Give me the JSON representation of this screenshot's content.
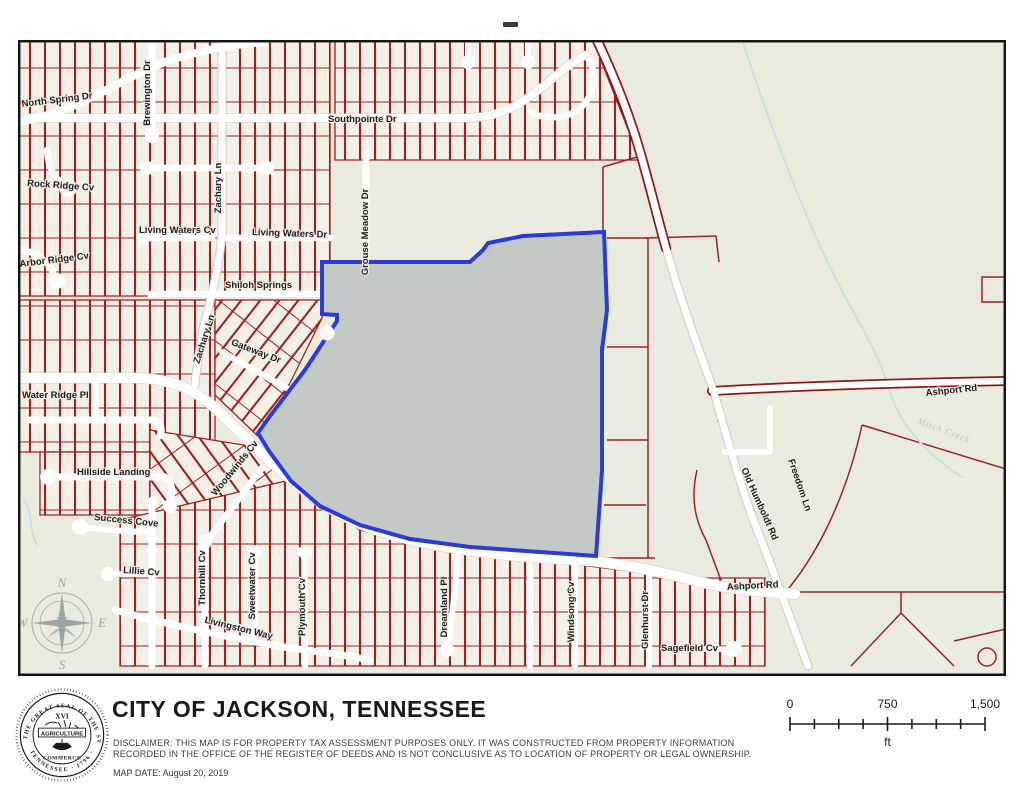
{
  "window": {
    "top_marker": "-"
  },
  "map": {
    "colors": {
      "parcel_line": "#a0201f",
      "highlight_fill": "#c3cac6",
      "highlight_stroke": "#2a3bd8",
      "road": "#ffffff",
      "open_land": "#e9ebdf",
      "subdivision_land": "#f3f1e7",
      "water": "#c9dfe5"
    },
    "compass": {
      "north": "N",
      "east": "E",
      "south": "S",
      "west": "W"
    },
    "street_labels": [
      {
        "id": "north-spring-dr",
        "t": "North Spring Dr",
        "x": 22,
        "y": 107,
        "r": -7,
        "a": "s"
      },
      {
        "id": "brewington-dr",
        "t": "Brewington Dr",
        "x": 150,
        "y": 93,
        "r": -90,
        "a": "m"
      },
      {
        "id": "southpointe-dr",
        "t": "Southpointe Dr",
        "x": 328,
        "y": 122,
        "r": 0,
        "a": "s"
      },
      {
        "id": "rock-ridge-cv",
        "t": "Rock Ridge Cv",
        "x": 27,
        "y": 186,
        "r": 4,
        "a": "s"
      },
      {
        "id": "zachary-ln-upper",
        "t": "Zachary Ln",
        "x": 221,
        "y": 188,
        "r": -90,
        "a": "m"
      },
      {
        "id": "living-waters-cv",
        "t": "Living Waters Cv",
        "x": 139,
        "y": 233,
        "r": 0,
        "a": "s"
      },
      {
        "id": "living-waters-dr",
        "t": "Living Waters Dr",
        "x": 252,
        "y": 235,
        "r": 2,
        "a": "s"
      },
      {
        "id": "grouse-meadow-dr",
        "t": "Grouse Meadow Dr",
        "x": 368,
        "y": 232,
        "r": -90,
        "a": "m"
      },
      {
        "id": "arbor-ridge-cv",
        "t": "Arbor Ridge Cv",
        "x": 20,
        "y": 267,
        "r": -7,
        "a": "s"
      },
      {
        "id": "shiloh-springs",
        "t": "Shiloh Springs",
        "x": 225,
        "y": 288,
        "r": 0,
        "a": "s"
      },
      {
        "id": "zachary-ln-lower",
        "t": "Zachary Ln",
        "x": 207,
        "y": 340,
        "r": -72,
        "a": "m"
      },
      {
        "id": "gateway-dr",
        "t": "Gateway Dr",
        "x": 255,
        "y": 354,
        "r": 21,
        "a": "m"
      },
      {
        "id": "water-ridge-pl",
        "t": "Water Ridge Pl",
        "x": 22,
        "y": 398,
        "r": 0,
        "a": "s"
      },
      {
        "id": "hillside-landing",
        "t": "Hillside Landing",
        "x": 77,
        "y": 475,
        "r": 0,
        "a": "s"
      },
      {
        "id": "woodwinds-cv",
        "t": "Woodwinds Cv",
        "x": 237,
        "y": 470,
        "r": -51,
        "a": "m"
      },
      {
        "id": "success-cove",
        "t": "Success Cove",
        "x": 94,
        "y": 520,
        "r": 6,
        "a": "s"
      },
      {
        "id": "lillie-cv",
        "t": "Lillie Cv",
        "x": 123,
        "y": 573,
        "r": 4,
        "a": "s"
      },
      {
        "id": "thornhill-cv",
        "t": "Thornhill Cv",
        "x": 205,
        "y": 578,
        "r": -90,
        "a": "m"
      },
      {
        "id": "sweetwater-cv",
        "t": "Sweetwater Cv",
        "x": 255,
        "y": 586,
        "r": -90,
        "a": "m"
      },
      {
        "id": "plymouth-cv",
        "t": "Plymouth Cv",
        "x": 305,
        "y": 607,
        "r": -90,
        "a": "m"
      },
      {
        "id": "livingston-way",
        "t": "Livingston Way",
        "x": 238,
        "y": 631,
        "r": 14,
        "a": "m"
      },
      {
        "id": "dreamland-pl",
        "t": "Dreamland Pl",
        "x": 447,
        "y": 607,
        "r": -90,
        "a": "m"
      },
      {
        "id": "windsong-cv",
        "t": "Windsong Cv",
        "x": 574,
        "y": 612,
        "r": -90,
        "a": "m"
      },
      {
        "id": "glenhurst-dr",
        "t": "Glenhurst Dr",
        "x": 648,
        "y": 620,
        "r": -90,
        "a": "m"
      },
      {
        "id": "sagefield-cv",
        "t": "Sagefield Cv",
        "x": 661,
        "y": 651,
        "r": 0,
        "a": "s"
      },
      {
        "id": "ashport-rd-south",
        "t": "Ashport Rd",
        "x": 727,
        "y": 590,
        "r": -3,
        "a": "s"
      },
      {
        "id": "ashport-rd-north",
        "t": "Ashport Rd",
        "x": 926,
        "y": 396,
        "r": -6,
        "a": "s"
      },
      {
        "id": "old-humboldt-rd",
        "t": "Old Humboldt Rd",
        "x": 757,
        "y": 505,
        "r": 66,
        "a": "m"
      },
      {
        "id": "freedom-ln",
        "t": "Freedom Ln",
        "x": 797,
        "y": 486,
        "r": 71,
        "a": "m"
      },
      {
        "id": "mitch-creek",
        "t": "Mitch Creek",
        "x": 943,
        "y": 433,
        "r": 21,
        "a": "m",
        "s": "water"
      }
    ]
  },
  "footer": {
    "title": "CITY OF JACKSON, TENNESSEE",
    "disclaimer_line1": "DISCLAIMER: THIS MAP IS FOR PROPERTY TAX ASSESSMENT PURPOSES ONLY. IT WAS CONSTRUCTED FROM PROPERTY INFORMATION",
    "disclaimer_line2": "RECORDED IN THE OFFICE OF THE REGISTER OF DEEDS AND IS NOT CONCLUSIVE AS TO LOCATION OF PROPERTY OR LEGAL OWNERSHIP.",
    "map_date": "MAP DATE: August 20, 2019",
    "seal": {
      "ring_top": "THE GREAT SEAL OF THE STATE OF",
      "ring_bottom": "TENNESSEE · 1796 ·",
      "roman_numeral": "XVI",
      "agriculture": "AGRICULTURE",
      "commerce": "COMMERCE"
    },
    "scale": {
      "start": "0",
      "middle": "750",
      "end": "1,500",
      "unit": "ft"
    }
  }
}
